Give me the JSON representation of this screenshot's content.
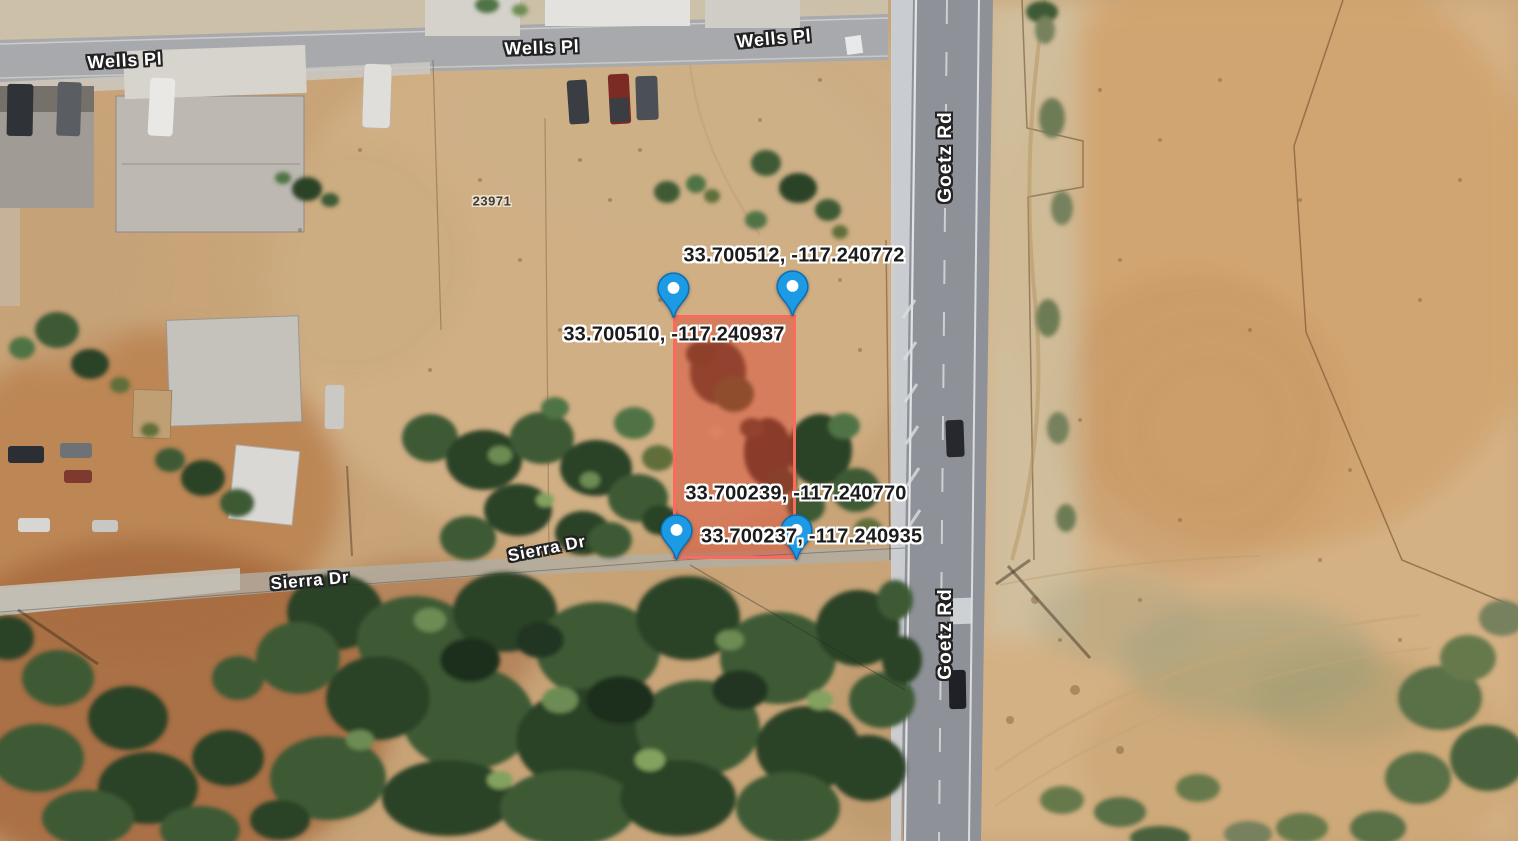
{
  "view": {
    "type": "satellite-map",
    "description": "Aerial imagery with highlighted parcel and corner coordinate pins"
  },
  "road_labels": [
    {
      "id": "wells-pl-left",
      "text": "Wells Pl"
    },
    {
      "id": "wells-pl-center",
      "text": "Wells Pl"
    },
    {
      "id": "wells-pl-right",
      "text": "Wells Pl"
    },
    {
      "id": "goetz-rd-upper",
      "text": "Goetz Rd"
    },
    {
      "id": "goetz-rd-lower",
      "text": "Goetz Rd"
    },
    {
      "id": "sierra-dr-left",
      "text": "Sierra Dr"
    },
    {
      "id": "sierra-dr-right",
      "text": "Sierra Dr"
    }
  ],
  "address_label": "23971",
  "parcel": {
    "highlight_fill": "rgba(221,58,41,0.42)",
    "highlight_border": "#fa6b5d",
    "pin_color": "#1c9be4",
    "corners": [
      {
        "position": "top-left",
        "coordinates": "33.700510, -117.240937"
      },
      {
        "position": "top-right",
        "coordinates": "33.700512, -117.240772"
      },
      {
        "position": "bottom-left",
        "coordinates": "33.700237, -117.240935"
      },
      {
        "position": "bottom-right",
        "coordinates": "33.700239, -117.240770"
      }
    ]
  }
}
